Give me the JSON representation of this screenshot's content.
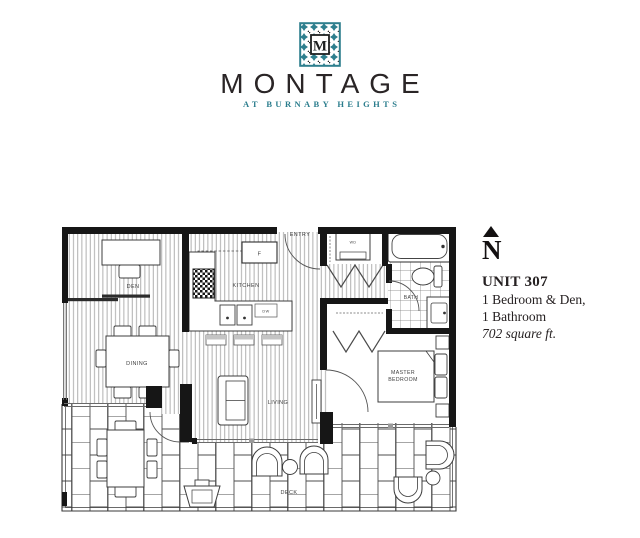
{
  "brand": {
    "logo_letter": "M",
    "name": "MONTAGE",
    "tagline": "AT BURNABY HEIGHTS",
    "teal": "#2B7D8D",
    "dark": "#2A2526"
  },
  "compass": {
    "letter": "N"
  },
  "unit": {
    "title": "UNIT 307",
    "lines": [
      "1 Bedroom & Den,",
      "1 Bathroom"
    ],
    "area": "702 square ft."
  },
  "floorplan": {
    "rooms": {
      "entry": "ENTRY",
      "den": "DEN",
      "dining": "DINING",
      "kitchen": "KITCHEN",
      "living": "LIVING",
      "bath": "BATH",
      "master_bedroom": [
        "MASTER",
        "BEDROOM"
      ],
      "deck": "DECK"
    },
    "appliances": {
      "washer_dryer": "WD",
      "fridge": "F",
      "dishwasher": "DW"
    }
  }
}
